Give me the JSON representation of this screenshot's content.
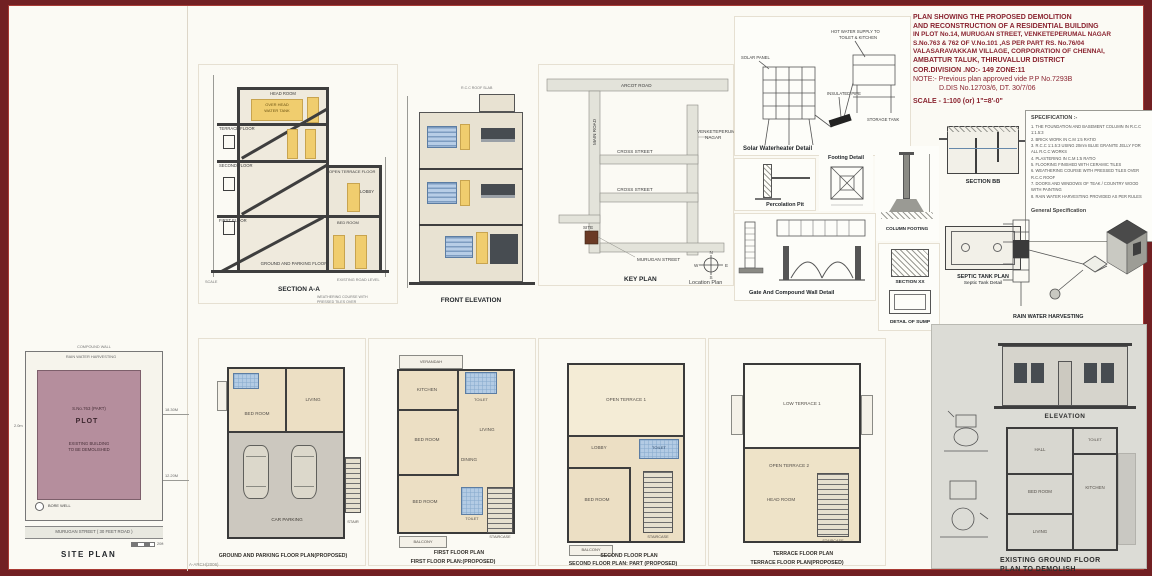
{
  "title_block": {
    "lines": [
      "PLAN SHOWING THE PROPOSED DEMOLITION",
      "AND RECONSTRUCTION OF A RESIDENTIAL BUILDING",
      "IN PLOT No.14, MURUGAN STREET, VENKETEPERUMAL NAGAR",
      "S.No.763 & 762 OF V.No.101 ,AS PER PART RS. No.76/04",
      "VALASARAVAKKAM VILLAGE, CORPORATION OF CHENNAI,",
      "AMBATTUR TALUK, THIRUVALLUR DISTRICT",
      "COR.DIVISION .NO:- 149   ZONE:11"
    ],
    "note1": "NOTE:- Previous plan approved vide P.P No.7293B",
    "note2": "D.DIS No.12703/6, DT. 30/7/06",
    "scale": "SCALE - 1:100   (or)   1\"=8'-0\""
  },
  "section_aa": {
    "caption": "SECTION A-A",
    "note1": "WEATHERING COURSE WITH",
    "note2": "PRESSED TILES OVER",
    "note3": "R.C.C ROOF SLAB",
    "head_room": "HEAD ROOM",
    "oht1": "OVER HEAD",
    "oht2": "WATER TANK",
    "terrace_floor": "TERRACE FLOOR",
    "second_floor": "SECOND FLOOR",
    "open_terrace": "OPEN TERRACE FLOOR",
    "lobby": "LOBBY",
    "first_floor": "FIRST FLOOR",
    "bed_room": "BED ROOM",
    "ground_floor": "GROUND AND PARKING FLOOR",
    "road_level": "EXISTING ROAD LEVEL",
    "scale_note": "SCALE"
  },
  "front_elevation": {
    "caption": "FRONT ELEVATION"
  },
  "key_plan": {
    "caption": "KEY PLAN",
    "caption2": "Location Plan",
    "road_top": "ARCOT ROAD",
    "road_left": "MAIN ROAD",
    "nagar1": "VENKETEPERUMAL",
    "nagar2": "NAGAR",
    "cross1": "CROSS STREET",
    "cross2": "CROSS STREET",
    "site_street": "MURUGAN STREET",
    "site": "SITE"
  },
  "solar": {
    "caption": "Solar Waterheater Detail",
    "panel": "SOLAR PANEL",
    "supply1": "HOT WATER SUPPLY TO",
    "supply2": "TOILET & KITCHEN",
    "pipe": "INSULATED PIPE",
    "tank": "STORAGE TANK"
  },
  "details": {
    "percolation": "Percolation Pit",
    "footing": "Footing Detail",
    "column_footing": "COLUMN FOOTING",
    "gate": "Gate And Compound Wall Detail",
    "section_xx": "SECTION XX",
    "sump": "DETAIL OF SUMP"
  },
  "section_bb": {
    "caption": "SECTION BB",
    "septic1": "SEPTIC TANK PLAN",
    "septic2": "Septic Tank Detail"
  },
  "spec": {
    "heading": "SPECIFICATION :-",
    "items": [
      "1. THE FOUNDATION AND BASEMENT COLUMN IN R.C.C 1:1.5:3",
      "2. BRICK WORK IN C.M 1:5 RATIO",
      "3. R.C.C 1:1.5:3 USING 20mm BLUE GRANITE JELLY FOR ALL R.C.C WORKS",
      "4. PLASTERING IN C.M 1:5 RATIO",
      "5. FLOORING FINISHED WITH CERAMIC TILES",
      "6. WEATHERING COURSE WITH PRESSED TILES OVER R.C.C ROOF",
      "7. DOORS AND WINDOWS OF TEAK / COUNTRY WOOD WITH PAINTING",
      "8. RAIN WATER HARVESTING PROVIDED AS PER RULES"
    ],
    "general": "General Specification"
  },
  "rwh": {
    "caption": "RAIN WATER HARVESTING"
  },
  "plans": {
    "ground": {
      "bed": "BED ROOM",
      "living": "LIVING",
      "parking": "CAR PARKING",
      "stair": "STAIR",
      "caption": "GROUND AND PARKING FLOOR PLAN(PROPOSED)"
    },
    "first": {
      "verandah": "VERANDAH",
      "kitchen": "KITCHEN",
      "toilet1": "TOILET",
      "bed1": "BED ROOM",
      "living": "LIVING",
      "dining": "DINING",
      "bed2": "BED ROOM",
      "toilet2": "TOILET",
      "stair": "STAIRCASE",
      "balcony": "BALCONY",
      "title": "FIRST FLOOR PLAN",
      "caption": "FIRST FLOOR PLAN:(PROPOSED)"
    },
    "second": {
      "terrace": "OPEN TERRACE 1",
      "toilet": "TOILET",
      "lobby": "LOBBY",
      "bed": "BED ROOM",
      "stair": "STAIRCASE",
      "balcony": "BALCONY",
      "title": "SECOND FLOOR PLAN",
      "caption": "SECOND FLOOR PLAN: PART (PROPOSED)"
    },
    "terrace": {
      "low": "LOW TERRACE 1",
      "open": "OPEN TERRACE 2",
      "head": "HEAD ROOM",
      "stair": "STAIRCASE",
      "title": "TERRACE FLOOR PLAN",
      "caption": "TERRACE FLOOR PLAN(PROPOSED)"
    }
  },
  "right_panel": {
    "elevation": "ELEVATION",
    "cap1": "EXISTING GROUND FLOOR",
    "cap2": "PLAN TO DEMOLISH",
    "hall": "HALL",
    "kitchen": "KITCHEN",
    "bed": "BED ROOM",
    "living": "LIVING",
    "toilet": "TOILET"
  },
  "site_plan": {
    "caption": "SITE PLAN",
    "compound": "COMPOUND WALL",
    "rwh": "RAIN WATER HARVESTING",
    "survey": "S.No.763 (PART)",
    "plot": "PLOT",
    "demo1": "EXISTING BUILDING",
    "demo2": "TO BE DEMOLISHED",
    "borewell": "BORE WELL",
    "road": "MURUGAN STREET ( 30 FEET ROAD )",
    "dim1": "18.30M",
    "dim2": "12.20M",
    "scalebar": "20ft",
    "left_dim": "2.0m"
  },
  "footer": {
    "sig": "A-ARCH(2006)"
  }
}
